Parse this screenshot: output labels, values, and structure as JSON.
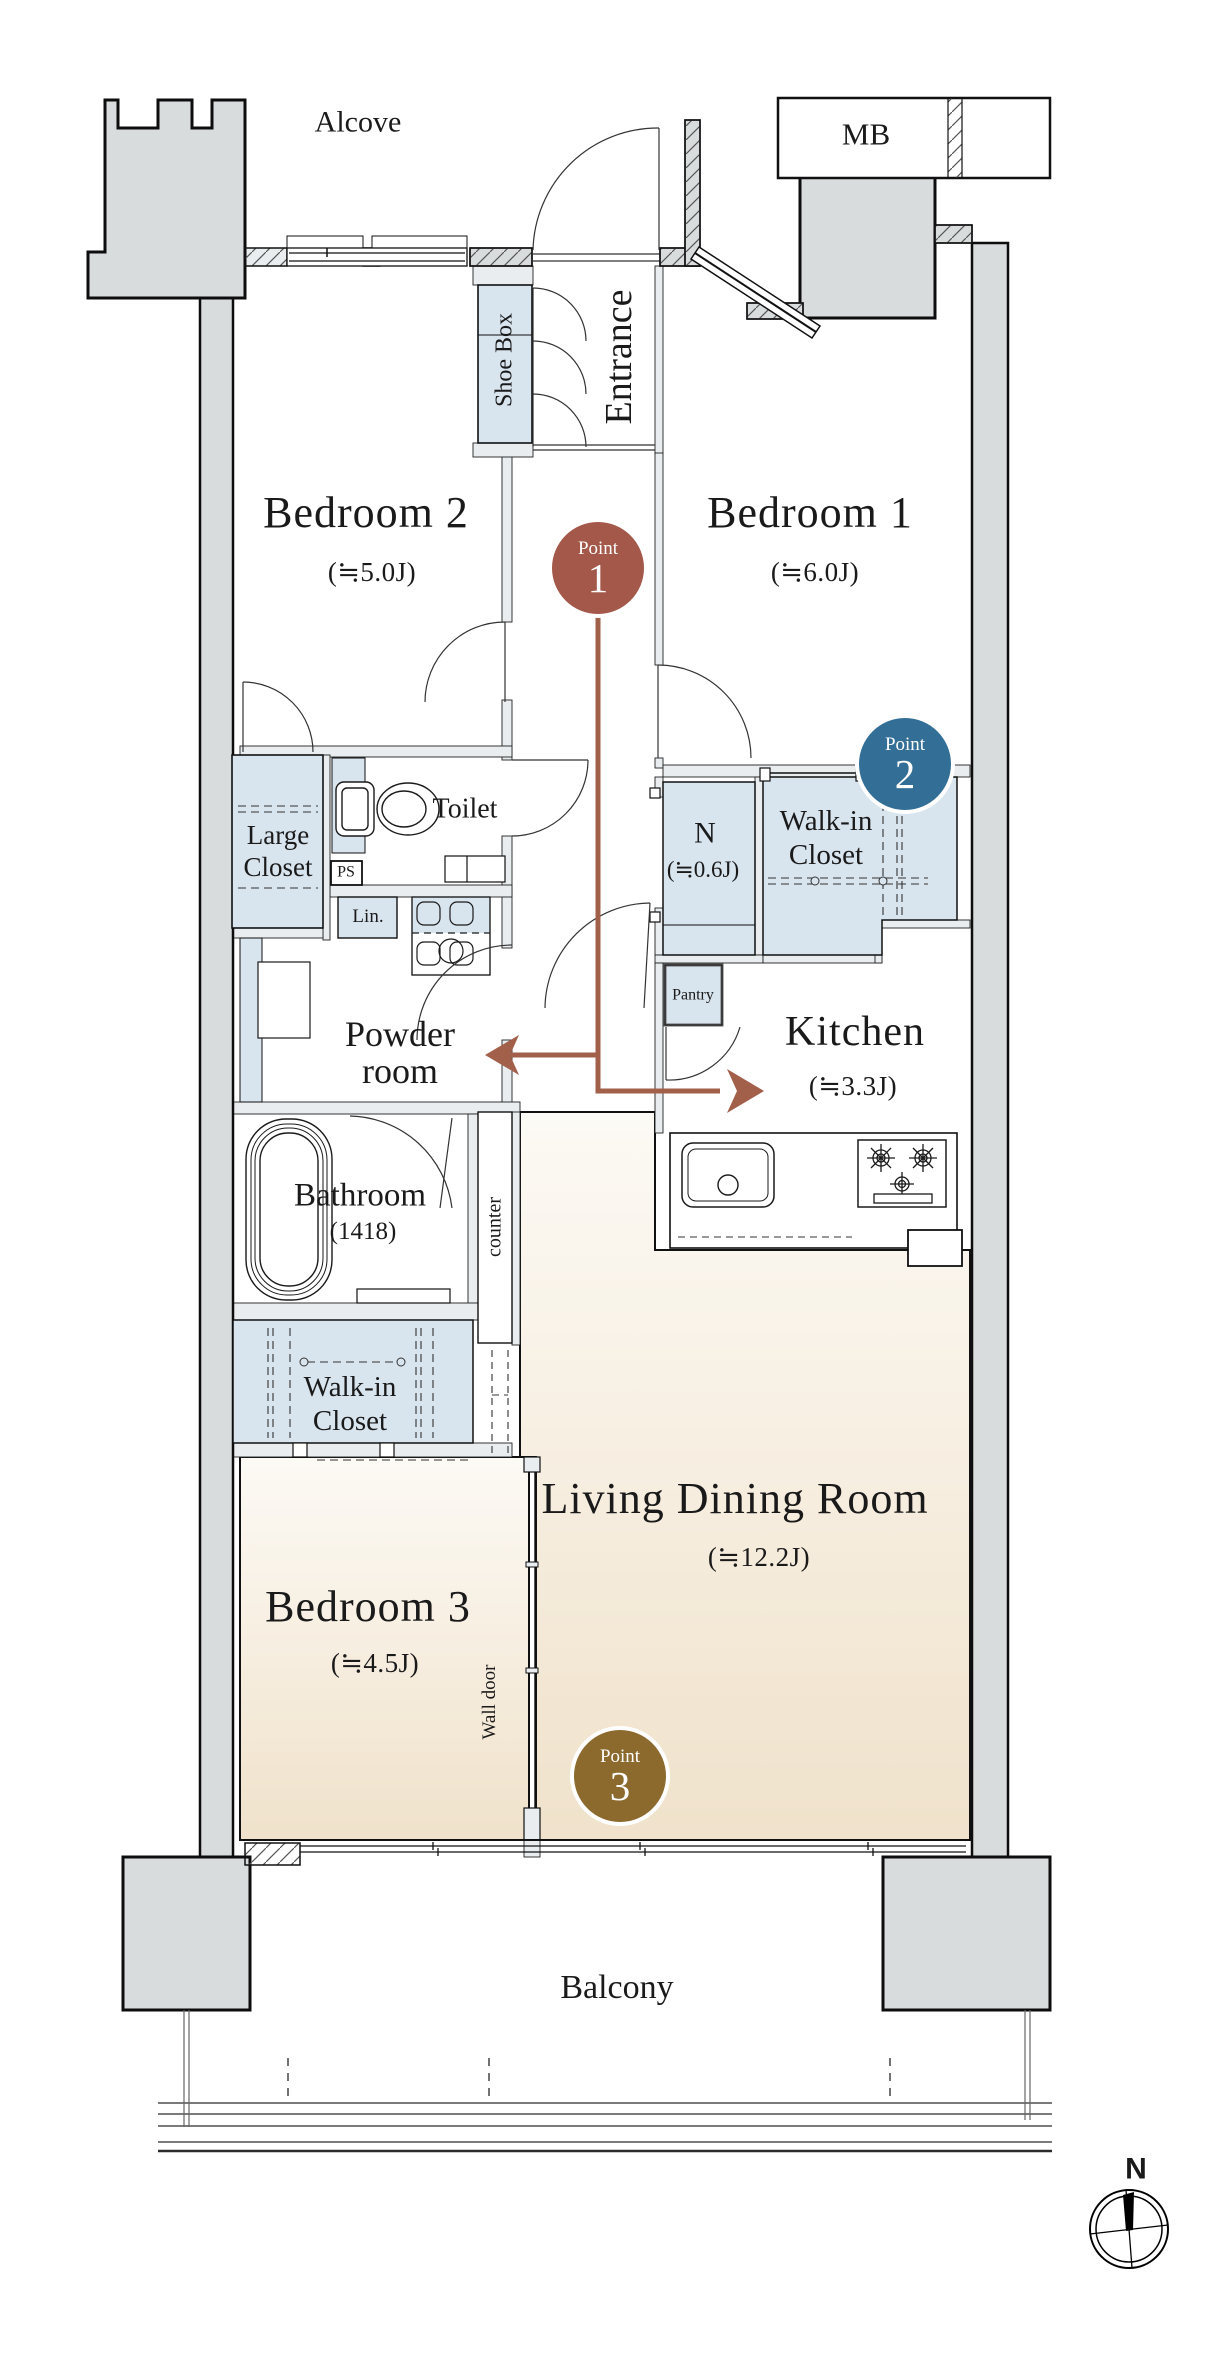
{
  "plan": {
    "areas": {
      "alcove": "Alcove",
      "mb": "MB",
      "balcony": "Balcony",
      "entrance": "Entrance",
      "shoe_box": "Shoe Box",
      "bedroom1": {
        "name": "Bedroom 1",
        "size": "(≒6.0J)"
      },
      "bedroom2": {
        "name": "Bedroom 2",
        "size": "(≒5.0J)"
      },
      "bedroom3": {
        "name": "Bedroom 3",
        "size": "(≒4.5J)"
      },
      "living_dining": {
        "name": "Living Dining Room",
        "size": "(≒12.2J)"
      },
      "kitchen": {
        "name": "Kitchen",
        "size": "(≒3.3J)"
      },
      "n_closet": {
        "name": "N",
        "size": "(≒0.6J)"
      },
      "toilet": "Toilet",
      "powder_room": {
        "line1": "Powder",
        "line2": "room"
      },
      "bathroom": {
        "name": "Bathroom",
        "size": "(1418)"
      },
      "walk_in_closet_upper": {
        "line1": "Walk-in",
        "line2": "Closet"
      },
      "walk_in_closet_lower": {
        "line1": "Walk-in",
        "line2": "Closet"
      },
      "large_closet": {
        "line1": "Large",
        "line2": "Closet"
      },
      "pantry": "Pantry",
      "linen": "Lin.",
      "ps_top": "PS",
      "ps_kitchen": "PS",
      "counter": "counter",
      "wall_door": "Wall door"
    },
    "points": [
      {
        "label": "Point",
        "number": "1",
        "color": "#a3584a"
      },
      {
        "label": "Point",
        "number": "2",
        "color": "#336e96"
      },
      {
        "label": "Point",
        "number": "3",
        "color": "#8c6a2e"
      }
    ],
    "compass": {
      "north": "N"
    },
    "colors": {
      "exterior_wall": "#d9dcdd",
      "wall_band": "#e9edef",
      "closet_blue": "#d8e4ee",
      "beige_top": "#fcfaf5",
      "beige_bottom": "#f0e2cb",
      "arrow": "#a2604b",
      "point1": "#a3584a",
      "point2": "#336e96",
      "point3": "#8c6a2e"
    }
  }
}
